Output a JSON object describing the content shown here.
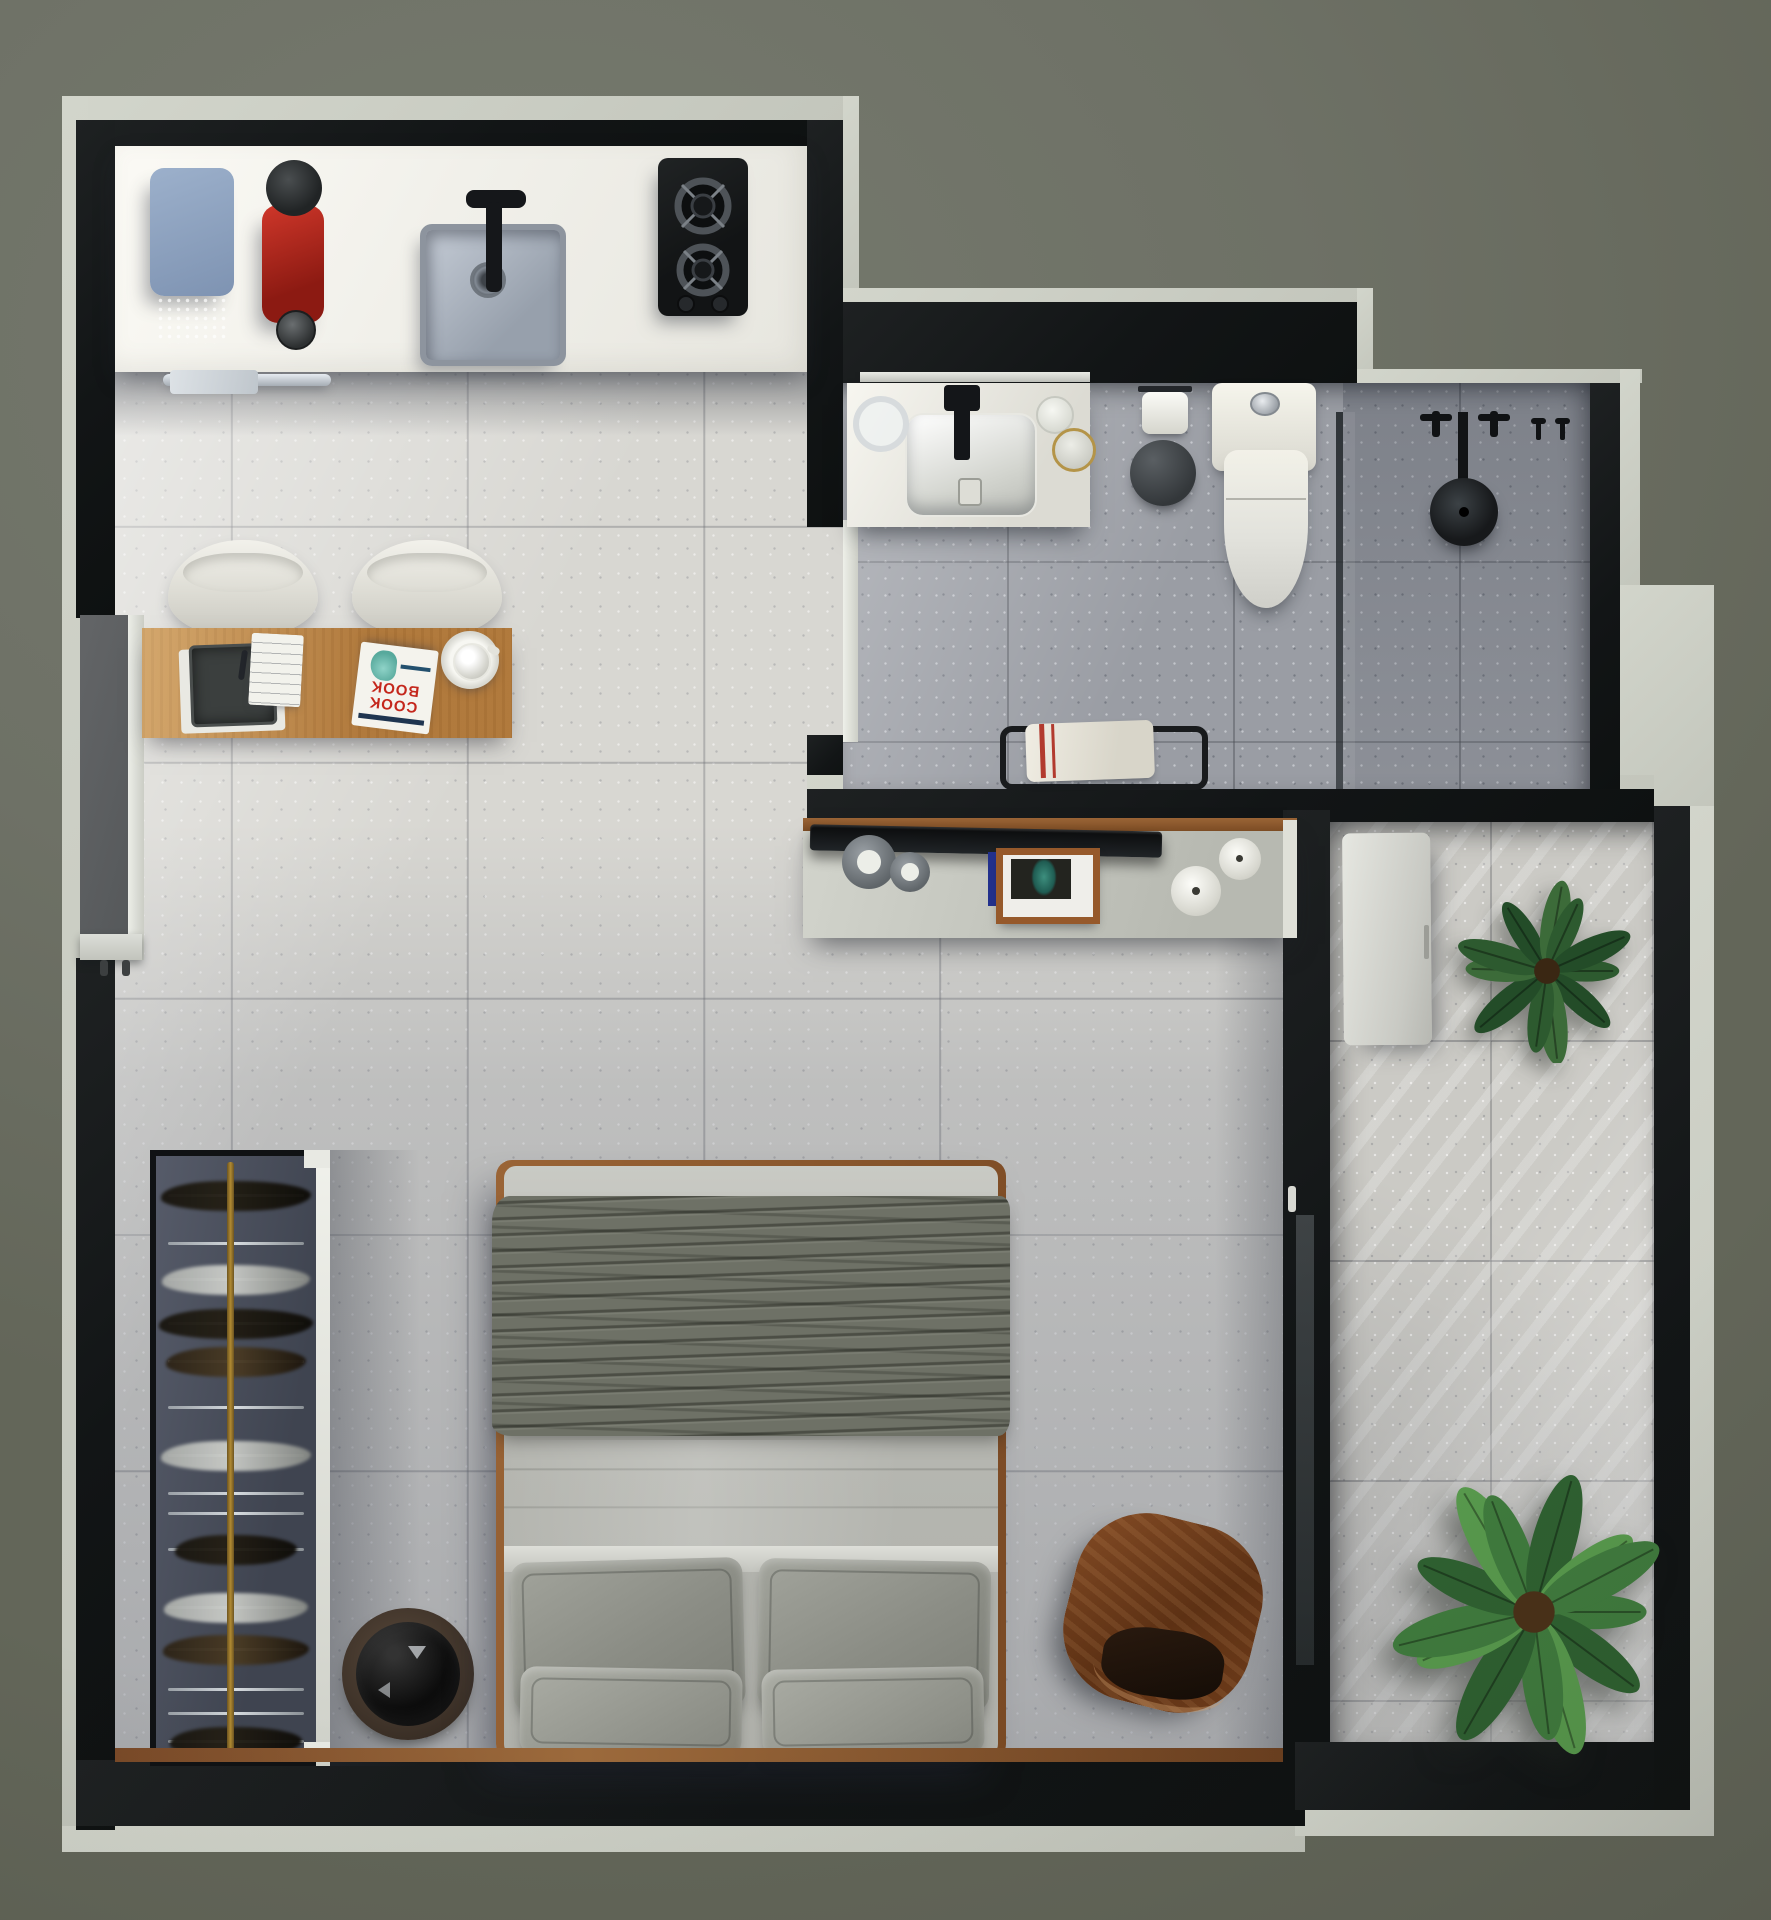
{
  "image": {
    "kind": "3d-rendered-apartment-floor-plan-top-view",
    "width": 1771,
    "height": 1920
  },
  "palette": {
    "background": "#6f7267",
    "plaster_band": "#cdd0c6",
    "wall": "#16191a",
    "floor_living": "#d8d7d2",
    "floor_bathroom": "#9aa0a6",
    "floor_balcony": "#cbcac5",
    "counter_white": "#f3f2ec",
    "desk_wood": "#c08a4e",
    "trim_wood": "#8a5a33",
    "coffee_machine_red": "#b22318",
    "toaster_blue": "#8ea3c2",
    "blanket_olive": "#6e7166",
    "linen_gray": "#b5b6b0",
    "pillow_gray": "#8f918a",
    "plant_green": "#3f7a3d",
    "lounge_walnut": "#6b3a1c",
    "wardrobe_interior": "#474c59",
    "rail_brass": "#a8852f"
  },
  "book": {
    "title_lines": [
      "COOK",
      "BOOK"
    ]
  },
  "plants": [
    {
      "host": "balcony-plant-top",
      "r": 92,
      "leaves": 11,
      "colors": [
        "#2d5a2f",
        "#234c28",
        "#3c6b39"
      ],
      "pot": "#3a2713"
    },
    {
      "host": "balcony-plant-large",
      "r": 148,
      "leaves": 13,
      "colors": [
        "#3f7a3d",
        "#2e6030",
        "#57984c"
      ],
      "pot": "#4a3118"
    }
  ],
  "wardrobe": {
    "hangers": [
      {
        "y": 38,
        "type": "dark",
        "w": 150
      },
      {
        "y": 86,
        "type": "bar",
        "w": 0
      },
      {
        "y": 122,
        "type": "steel",
        "w": 148
      },
      {
        "y": 166,
        "type": "dark",
        "w": 154
      },
      {
        "y": 204,
        "type": "brown",
        "w": 140
      },
      {
        "y": 250,
        "type": "bar",
        "w": 0
      },
      {
        "y": 298,
        "type": "steel",
        "w": 150
      },
      {
        "y": 336,
        "type": "bar",
        "w": 0
      },
      {
        "y": 356,
        "type": "bar",
        "w": 0
      },
      {
        "y": 392,
        "type": "dark",
        "w": 122
      },
      {
        "y": 450,
        "type": "steel",
        "w": 144
      },
      {
        "y": 492,
        "type": "brown",
        "w": 146
      },
      {
        "y": 532,
        "type": "bar",
        "w": 0
      },
      {
        "y": 556,
        "type": "bar",
        "w": 0
      },
      {
        "y": 584,
        "type": "dark",
        "w": 132
      }
    ]
  },
  "scene": {
    "rooms": [
      {
        "name": "kitchen-living",
        "items": [
          "kitchen-counter",
          "toaster",
          "coffee-machine",
          "kitchen-sink",
          "cooktop-two-burner",
          "towel-rail",
          "desk",
          "white-chair",
          "white-chair",
          "laptop",
          "notepad",
          "cookbook",
          "coffee-cup"
        ]
      },
      {
        "name": "bathroom",
        "items": [
          "vanity-counter",
          "wash-basin",
          "black-faucet",
          "glass-cup",
          "candle-jar",
          "gold-rim-jar",
          "toilet",
          "toilet-paper-roll",
          "waste-bin",
          "towel-bench",
          "shower-glass-partition",
          "rain-shower-head",
          "shower-valves",
          "towel-hooks"
        ]
      },
      {
        "name": "bedroom",
        "items": [
          "open-wardrobe",
          "clothes-rail",
          "round-speaker",
          "double-bed",
          "olive-blanket",
          "pillows",
          "walnut-lounge-chair",
          "tv-console",
          "television",
          "picture-frame",
          "decor-vases"
        ]
      },
      {
        "name": "balcony",
        "items": [
          "storage-cabinet",
          "potted-plant",
          "large-potted-plant",
          "sliding-glass-door"
        ]
      },
      {
        "name": "entry",
        "items": [
          "entry-door",
          "entry-corridor"
        ]
      }
    ]
  }
}
